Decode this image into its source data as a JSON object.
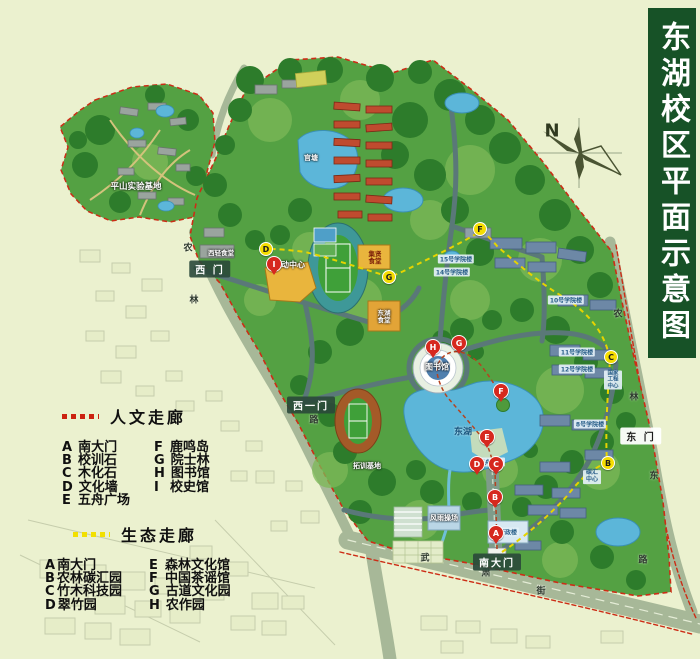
{
  "title": "东湖校区平面示意图",
  "compass": {
    "label": "N"
  },
  "legends": {
    "humanities": {
      "title": "人文走廊",
      "dash_color": "#cc2211",
      "items": [
        {
          "letter": "A",
          "name": "南大门"
        },
        {
          "letter": "B",
          "name": "校训石"
        },
        {
          "letter": "C",
          "name": "木化石"
        },
        {
          "letter": "D",
          "name": "文化墙"
        },
        {
          "letter": "E",
          "name": "五舟广场"
        },
        {
          "letter": "F",
          "name": "鹿鸣岛"
        },
        {
          "letter": "G",
          "name": "院士林"
        },
        {
          "letter": "H",
          "name": "图书馆"
        },
        {
          "letter": "I",
          "name": "校史馆"
        }
      ]
    },
    "ecology": {
      "title": "生态走廊",
      "dash_color": "#f2e000",
      "items": [
        {
          "letter": "A",
          "name": "南大门"
        },
        {
          "letter": "B",
          "name": "农林碳汇园"
        },
        {
          "letter": "C",
          "name": "竹木科技园"
        },
        {
          "letter": "D",
          "name": "翠竹园"
        },
        {
          "letter": "E",
          "name": "森林文化馆"
        },
        {
          "letter": "F",
          "name": "中国茶谣馆"
        },
        {
          "letter": "G",
          "name": "古道文化园"
        },
        {
          "letter": "H",
          "name": "农作园"
        }
      ]
    }
  },
  "map": {
    "gates": {
      "west": "西 门",
      "west_one": "西一门",
      "east": "东 门",
      "south": "南大门"
    },
    "labels": {
      "pingshan_base": "平山实验基地",
      "xiqing_canteen": "西轻食堂",
      "activity_center": "活动中心",
      "jixian_canteen": "集贤食堂",
      "donghu_canteen": "东湖食堂",
      "guantang_pond": "官塘",
      "library": "图书馆",
      "east_lake": "东湖",
      "wuzhou_square": "五舟广场",
      "tuoxun_base": "拓训基地",
      "windrain_ground": "风雨操场",
      "admin_building": "行政楼",
      "carbon_center": "碳汇中心",
      "engineering_center": "国家工程中心"
    },
    "academic_buildings": [
      "15号学院楼",
      "14号学院楼",
      "11号学院楼",
      "12号学院楼",
      "10号学院楼",
      "8号学院楼"
    ],
    "streets": {
      "west": [
        "农",
        "林",
        "路"
      ],
      "east": [
        "农",
        "林",
        "东",
        "路"
      ],
      "south": [
        "武",
        "肃",
        "街"
      ]
    },
    "red_pins": [
      {
        "letter": "A"
      },
      {
        "letter": "B"
      },
      {
        "letter": "C"
      },
      {
        "letter": "D"
      },
      {
        "letter": "E"
      },
      {
        "letter": "F"
      },
      {
        "letter": "G"
      },
      {
        "letter": "H"
      },
      {
        "letter": "I"
      }
    ],
    "yellow_pins": [
      {
        "letter": "B"
      },
      {
        "letter": "C"
      },
      {
        "letter": "D"
      },
      {
        "letter": "F"
      },
      {
        "letter": "G"
      }
    ]
  },
  "colors": {
    "banner_green": "#175227",
    "campus_green": "#54a143",
    "lake_blue": "#5cb6d9",
    "pin_red": "#d6281e",
    "pin_yellow": "#f5dd00"
  }
}
